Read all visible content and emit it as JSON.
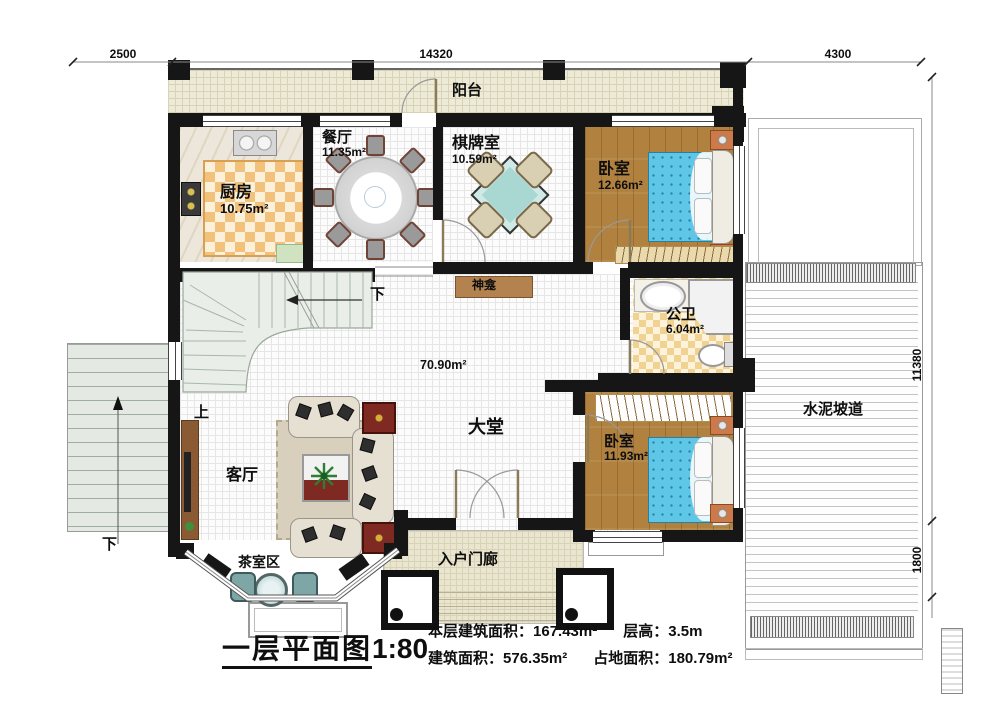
{
  "dims": {
    "top": [
      "2500",
      "14320",
      "4300"
    ],
    "right": [
      "11380",
      "1800"
    ]
  },
  "rooms": {
    "balcony": {
      "name": "阳台"
    },
    "kitchen": {
      "name": "厨房",
      "area": "10.75m²"
    },
    "dining": {
      "name": "餐厅",
      "area": "11.35m²"
    },
    "chess": {
      "name": "棋牌室",
      "area": "10.59m²"
    },
    "bedroom1": {
      "name": "卧室",
      "area": "12.66m²"
    },
    "shrine": {
      "name": "神龛"
    },
    "bathroom": {
      "name": "公卫",
      "area": "6.04m²"
    },
    "hall": {
      "name": "大堂",
      "area": "70.90m²"
    },
    "living": {
      "name": "客厅"
    },
    "bedroom2": {
      "name": "卧室",
      "area": "11.93m²"
    },
    "tea": {
      "name": "茶室区"
    },
    "porch": {
      "name": "入户门廊"
    },
    "ramp": {
      "name": "水泥坡道"
    }
  },
  "stairs": {
    "up": "上",
    "down": "下",
    "down_exterior": "下"
  },
  "footer": {
    "title": "一层平面图",
    "scale": "1:80",
    "items": [
      {
        "label": "本层建筑面积：",
        "value": "167.43m²"
      },
      {
        "label": "层高：",
        "value": "3.5m"
      },
      {
        "label": "建筑面积：",
        "value": "576.35m²"
      },
      {
        "label": "占地面积：",
        "value": "180.79m²"
      }
    ]
  },
  "colors": {
    "wall": "#161616",
    "wood_floor": "#b0813f",
    "bed_blue": "#5ec7e8",
    "kitchen_checker": "#f2c27d",
    "balcony_tile": "#edead7"
  }
}
